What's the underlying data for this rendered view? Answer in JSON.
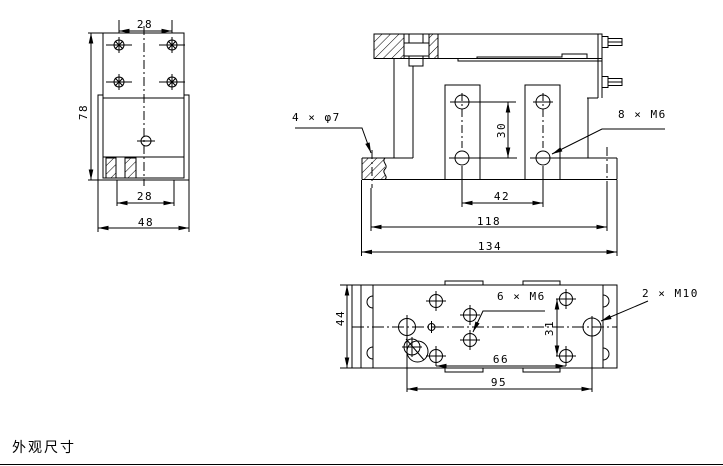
{
  "sheet": {
    "caption": "外观尺寸",
    "line_color": "#000000",
    "background_color": "#ffffff"
  },
  "side_view": {
    "dim_hole_spacing_top": "28",
    "dim_height": "78",
    "dim_slot_spacing": "28",
    "dim_width": "48"
  },
  "front_view": {
    "label_clearance_holes": "4 × φ7",
    "label_thread_holes": "8 × M6",
    "dim_hole_vertical_spacing": "30",
    "dim_hole_spacing": "42",
    "dim_mount_spacing": "118",
    "dim_overall_length": "134"
  },
  "top_view": {
    "label_thread_holes_m6": "6 × M6",
    "label_thread_holes_m10": "2 × M10",
    "dim_width": "44",
    "dim_hole_vertical_spacing": "31",
    "dim_hole_spacing": "66",
    "dim_mount_spacing": "95"
  }
}
